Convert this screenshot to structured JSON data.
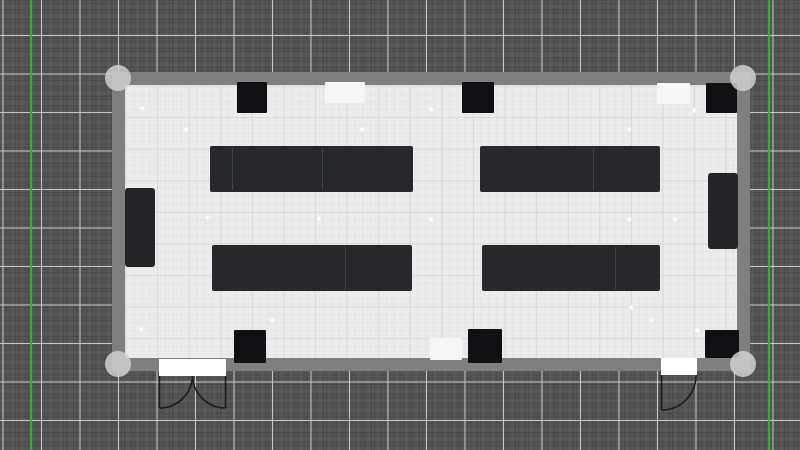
{
  "canvas": {
    "background_color": "#575757",
    "grid_major_color": "#c6c6c6",
    "guide_color": "#2bb52b",
    "guides_x": [
      30,
      768
    ],
    "guide_width": 2
  },
  "room": {
    "wall_color": "#7f7f7f",
    "floor_color": "#ececec",
    "outer_rect": [
      112,
      72,
      638,
      299
    ],
    "inner_rect": [
      125,
      85,
      612,
      273
    ],
    "corner_handle_color": "rgba(208,208,208,0.85)",
    "corner_handle_radius": 13,
    "corner_handles": [
      [
        118,
        78
      ],
      [
        743,
        78
      ],
      [
        118,
        364
      ],
      [
        743,
        364
      ]
    ]
  },
  "furniture": {
    "desk_color": "#26282c",
    "seam_color": "#42464c",
    "desk_rows": [
      {
        "rect": [
          210,
          146,
          203,
          46
        ],
        "seams": [
          22,
          112
        ]
      },
      {
        "rect": [
          480,
          146,
          180,
          46
        ],
        "seams": [
          113
        ]
      },
      {
        "rect": [
          212,
          245,
          200,
          46
        ],
        "seams": [
          133
        ]
      },
      {
        "rect": [
          482,
          245,
          178,
          46
        ],
        "seams": [
          133
        ]
      }
    ],
    "wall_box_color": "#101114",
    "wall_boxes": [
      [
        237,
        82,
        30,
        31
      ],
      [
        462,
        82,
        32,
        31
      ],
      [
        706,
        83,
        31,
        30
      ],
      [
        234,
        330,
        32,
        33
      ],
      [
        468,
        329,
        34,
        34
      ],
      [
        705,
        330,
        34,
        28
      ]
    ],
    "wall_panel_color": "#f6f6f8",
    "wall_panels": [
      [
        325,
        82,
        40,
        21
      ],
      [
        657,
        83,
        33,
        21
      ],
      [
        430,
        338,
        32,
        22
      ]
    ],
    "cabinet_color": "#222428",
    "side_cabinets": [
      [
        125,
        188,
        30,
        79
      ],
      [
        708,
        173,
        30,
        76
      ]
    ]
  },
  "doors": {
    "stroke_color": "#1a1a1a",
    "leaf_fill": "#ffffff",
    "items": [
      {
        "name": "double-door",
        "rect": [
          159,
          359,
          67,
          17
        ],
        "paths": [
          "M159.5,376 L159.5,408",
          "M225.5,376 L225.5,408",
          "M192.5,376 A33,33 0 0 1 159.5,408",
          "M192.5,376 A33,33 0 0 0 225.5,408"
        ]
      },
      {
        "name": "single-door",
        "rect": [
          661,
          358,
          36,
          17
        ],
        "paths": [
          "M661.5,375 L661.5,410",
          "M696,375 A34.5,34.5 0 0 1 661.5,410"
        ]
      }
    ]
  },
  "lights": {
    "glyph": "✦",
    "color": "#ffffff",
    "points": [
      [
        143,
        111
      ],
      [
        187,
        132
      ],
      [
        363,
        132
      ],
      [
        432,
        112
      ],
      [
        630,
        132
      ],
      [
        695,
        113
      ],
      [
        208,
        220
      ],
      [
        320,
        221
      ],
      [
        432,
        222
      ],
      [
        630,
        222
      ],
      [
        676,
        222
      ],
      [
        142,
        332
      ],
      [
        273,
        323
      ],
      [
        632,
        310
      ],
      [
        652,
        323
      ],
      [
        698,
        333
      ]
    ]
  }
}
